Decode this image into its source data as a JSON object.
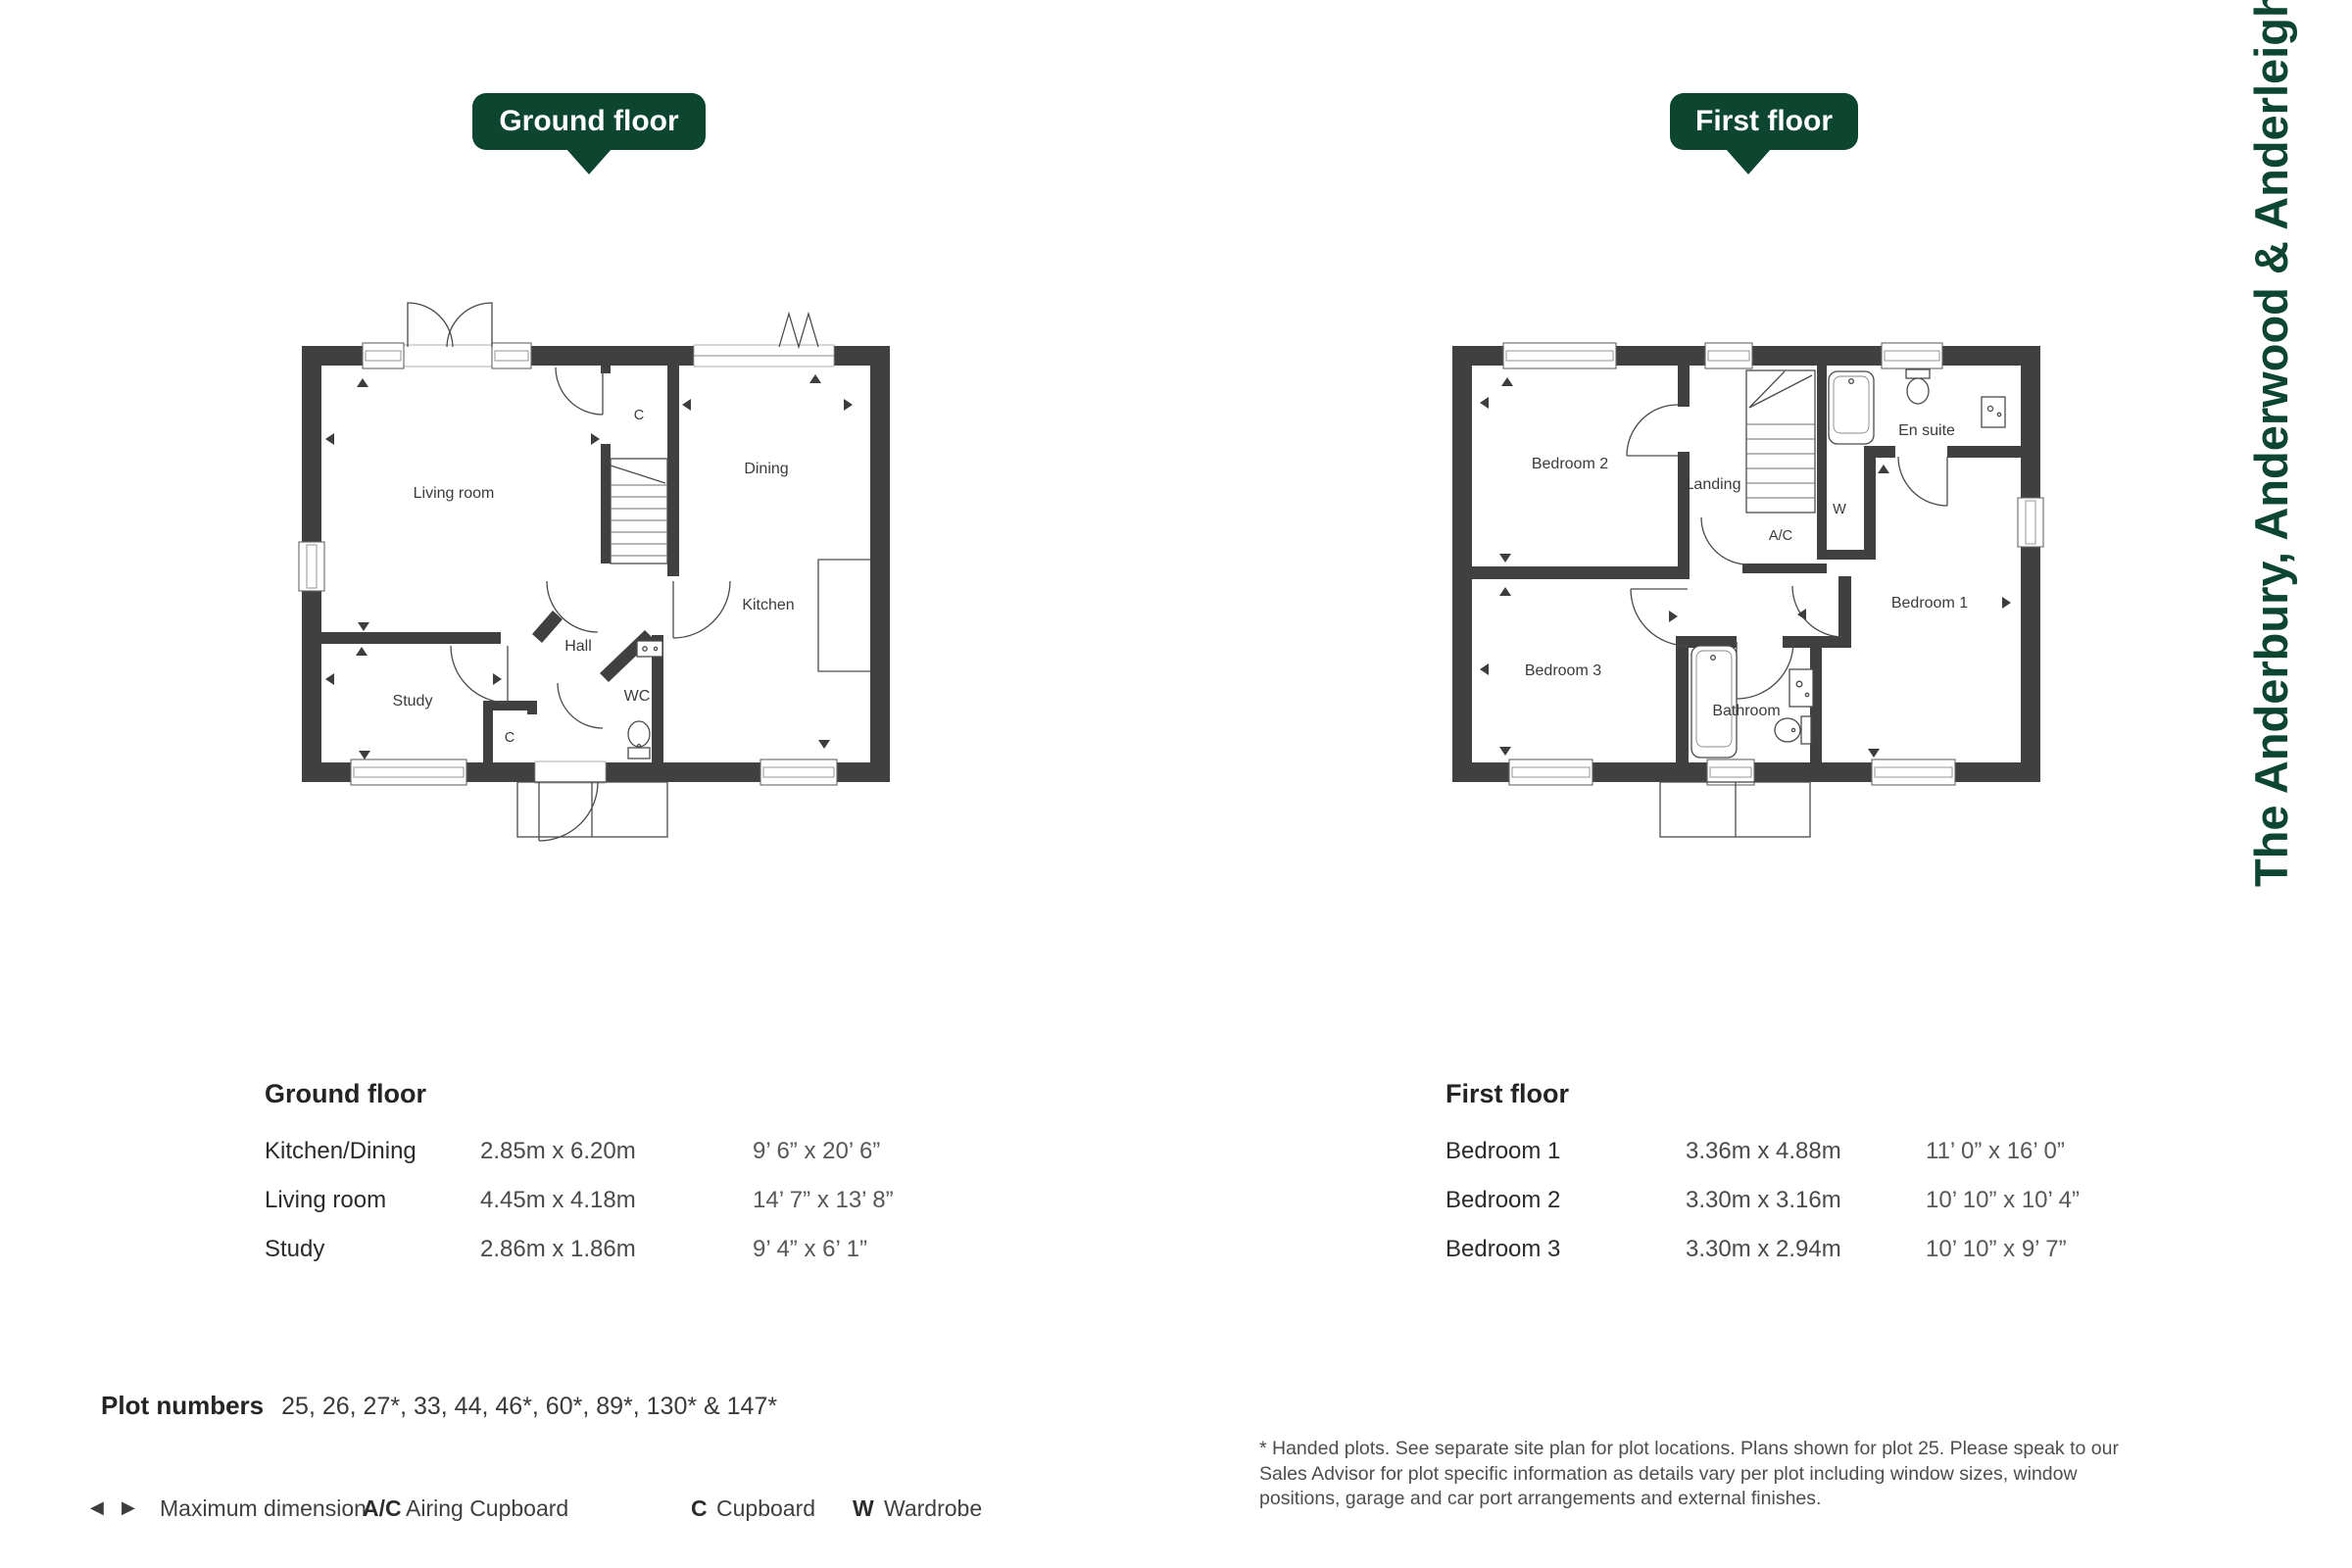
{
  "page_title_vertical": "The Anderbury, Anderwood & Anderleigh",
  "colors": {
    "brand_green": "#0d4630",
    "wall": "#404040"
  },
  "plans": {
    "ground": {
      "badge": "Ground floor",
      "rooms": {
        "living": "Living room",
        "dining": "Dining",
        "kitchen": "Kitchen",
        "hall": "Hall",
        "study": "Study",
        "wc": "WC",
        "cupboard_a": "C",
        "cupboard_b": "C"
      }
    },
    "first": {
      "badge": "First floor",
      "rooms": {
        "bedroom2": "Bedroom 2",
        "landing": "Landing",
        "ensuite": "En suite",
        "wardrobe": "W",
        "airing": "A/C",
        "bedroom1": "Bedroom 1",
        "bedroom3": "Bedroom 3",
        "bathroom": "Bathroom"
      }
    }
  },
  "tables": {
    "ground": {
      "header": "Ground floor",
      "rows": [
        {
          "room": "Kitchen/Dining",
          "metric": "2.85m x 6.20m",
          "imperial": "9’ 6” x 20’ 6”"
        },
        {
          "room": "Living room",
          "metric": "4.45m x 4.18m",
          "imperial": "14’ 7” x 13’ 8”"
        },
        {
          "room": "Study",
          "metric": "2.86m x 1.86m",
          "imperial": "9’ 4” x 6’ 1”"
        }
      ]
    },
    "first": {
      "header": "First floor",
      "rows": [
        {
          "room": "Bedroom 1",
          "metric": "3.36m x 4.88m",
          "imperial": "11’ 0” x 16’ 0”"
        },
        {
          "room": "Bedroom 2",
          "metric": "3.30m x 3.16m",
          "imperial": "10’ 10” x 10’ 4”"
        },
        {
          "room": "Bedroom 3",
          "metric": "3.30m x 2.94m",
          "imperial": "10’ 10” x 9’ 7”"
        }
      ]
    }
  },
  "plot_numbers": {
    "label": "Plot numbers",
    "values": "25, 26, 27*, 33, 44, 46*, 60*, 89*, 130* & 147*"
  },
  "legend": {
    "max_dimension": "Maximum dimension",
    "airing_abbr": "A/C",
    "airing": "Airing Cupboard",
    "cupboard_abbr": "C",
    "cupboard": "Cupboard",
    "wardrobe_abbr": "W",
    "wardrobe": "Wardrobe"
  },
  "disclaimer": "* Handed plots. See separate site plan for plot locations. Plans shown for plot 25. Please speak to our Sales Advisor for plot specific information as details vary per plot including window sizes, window positions, garage and car port arrangements and external finishes."
}
